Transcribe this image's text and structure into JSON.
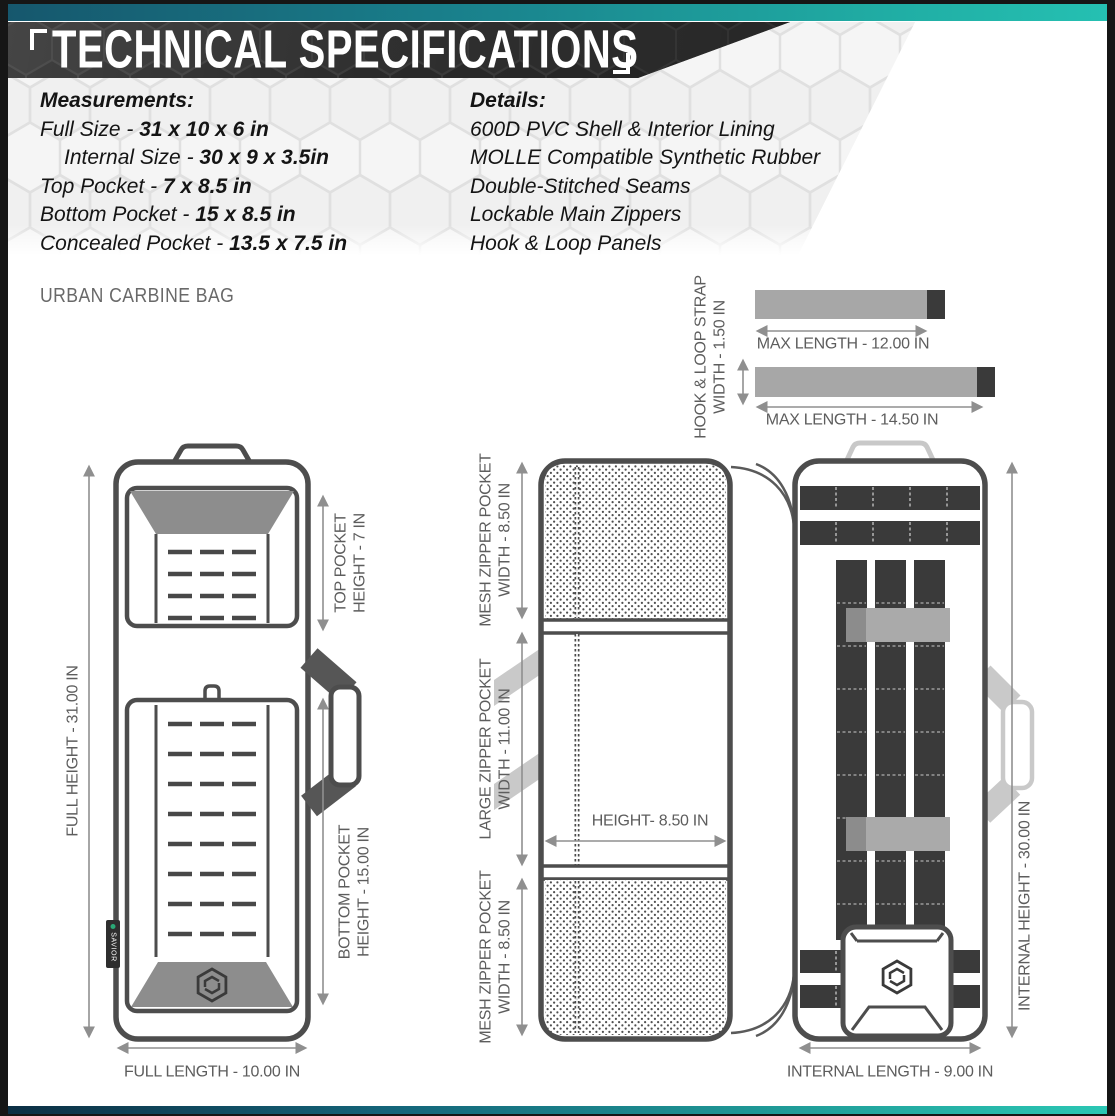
{
  "header": {
    "title": "TECHNICAL SPECIFICATIONS"
  },
  "specs": {
    "measurements": {
      "heading": "Measurements:",
      "items": [
        {
          "label": "Full Size - ",
          "value": "31 x 10 x 6 in"
        },
        {
          "label": "Internal Size - ",
          "value": "30 x 9 x 3.5in"
        },
        {
          "label": "Top Pocket - ",
          "value": "7 x 8.5 in"
        },
        {
          "label": "Bottom Pocket - ",
          "value": "15 x 8.5 in"
        },
        {
          "label": "Concealed Pocket - ",
          "value": "13.5 x 7.5 in"
        }
      ]
    },
    "details": {
      "heading": "Details:",
      "items": [
        "600D PVC Shell & Interior Lining",
        "MOLLE Compatible Synthetic Rubber",
        "Double-Stitched Seams",
        "Lockable Main Zippers",
        "Hook & Loop Panels"
      ]
    }
  },
  "product_name": "URBAN CARBINE BAG",
  "strap_diagram": {
    "width_label": {
      "line1": "HOOK & LOOP STRAP",
      "line2": "WIDTH - 1.50 IN"
    },
    "strap_short": {
      "max_length": "MAX LENGTH - 12.00 IN"
    },
    "strap_long": {
      "max_length": "MAX LENGTH - 14.50 IN"
    }
  },
  "front_view": {
    "labels": {
      "full_height": "FULL HEIGHT - 31.00 IN",
      "top_pocket": {
        "line1": "TOP POCKET",
        "line2": "HEIGHT - 7 IN"
      },
      "bottom_pocket": {
        "line1": "BOTTOM POCKET",
        "line2": "HEIGHT - 15.00 IN"
      },
      "full_length": "FULL LENGTH - 10.00 IN"
    },
    "brand_tag": "SAVIOR"
  },
  "inner_view": {
    "labels": {
      "mesh_pocket_top": {
        "line1": "MESH ZIPPER POCKET",
        "line2": "WIDTH - 8.50 IN"
      },
      "large_pocket": {
        "line1": "LARGE ZIPPER POCKET",
        "line2": "WIDTH - 11.00 IN"
      },
      "pocket_height": "HEIGHT- 8.50 IN",
      "mesh_pocket_bottom": {
        "line1": "MESH ZIPPER POCKET",
        "line2": "WIDTH - 8.50 IN"
      }
    }
  },
  "internal_view": {
    "labels": {
      "internal_height": "INTERNAL HEIGHT - 30.00 IN",
      "internal_length": "INTERNAL LENGTH - 9.00 IN"
    }
  },
  "colors": {
    "teal_accent": "#20ada4",
    "banner_dark": "#2a2a2a",
    "outline_dark": "#4d4d4d",
    "panel_gray": "#8d8d8d",
    "strap_gray": "#a7a7a7",
    "strap_dark": "#3a3a3a",
    "dim_text": "#5d5d5d",
    "tag_green": "#2aa876"
  }
}
